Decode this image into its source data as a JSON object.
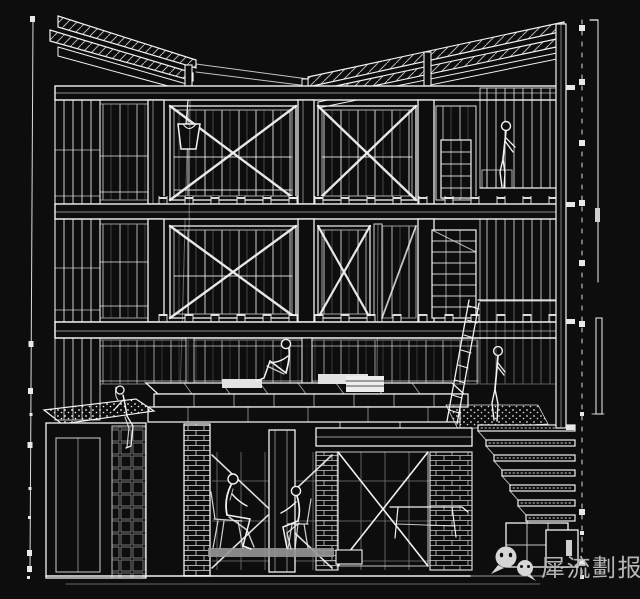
{
  "meta": {
    "title": "Architectural section-perspective wireframe drawing",
    "style": "white line drawing on black background"
  },
  "colors": {
    "background": "#0d0d0d",
    "line": "#f2f2f2",
    "watermark_text": "#b5b5b5",
    "watermark_icon": "#d6d6d6"
  },
  "watermark": {
    "text": "犀流劃报",
    "icon": "wechat-icon"
  },
  "scene": {
    "elements": [
      "mono-pitch roof planes with hatched exposed rafters",
      "three storeys of timber frame bays with X cross-bracing",
      "glazed curtain-wall mullion grids",
      "bucket hanging from a rope at roof level",
      "central stacked-timber platform with seated figure",
      "figure seated on gravel-topped planter box at left",
      "figure at shelving on upper-right mezzanine",
      "standing figure on gravel terrace",
      "leaning ladder",
      "cascading stair treads descending to the right",
      "two suited figures on folding chairs in the undercroft",
      "brick-hatched columns and walls",
      "vertical survey dimension lines with square ticks on both edges"
    ]
  }
}
